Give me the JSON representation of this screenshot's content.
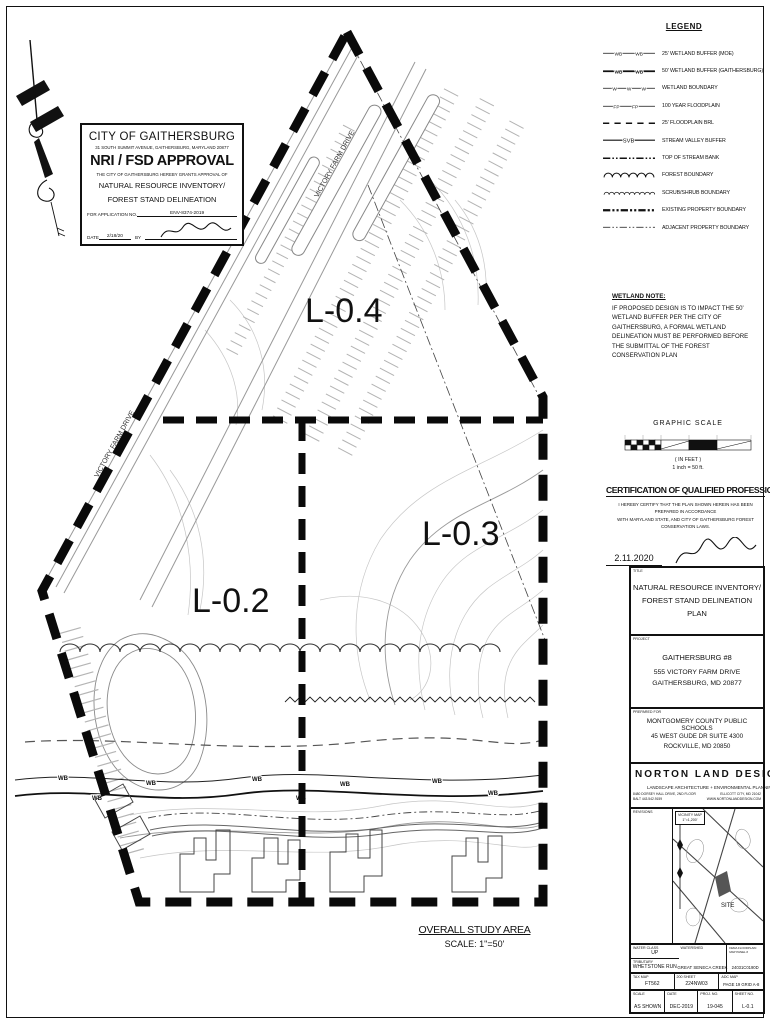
{
  "sheet": {
    "study_area_title": "OVERALL STUDY AREA",
    "study_area_scale": "SCALE: 1\"=50'"
  },
  "map": {
    "labels": {
      "l04": "L-0.4",
      "l03": "L-0.3",
      "l02": "L-0.2",
      "road": "VICTORY FARM DRIVE",
      "wb": "WB"
    }
  },
  "stamp": {
    "line1": "CITY OF GAITHERSBURG",
    "line2": "31 SOUTH SUMMIT AVENUE, GAITHERSBURG, MARYLAND 20877",
    "line3": "NRI / FSD APPROVAL",
    "line4": "THE CITY OF GAITHERSBURG HEREBY GRANTS APPROVAL OF",
    "line5": "NATURAL RESOURCE INVENTORY/",
    "line6": "FOREST STAND DELINEATION",
    "app_label": "FOR APPLICATION NO.",
    "app_no": "ENV-8374-2019",
    "date_label": "DATE",
    "date_value": "2/18/20",
    "by_label": "BY"
  },
  "legend": {
    "title": "LEGEND",
    "wb_marker": "WB",
    "w_marker": "W",
    "fp_marker": "FP",
    "svb_marker": "SVB",
    "items": [
      {
        "symbol": "wetland-buffer-25",
        "label": "25' WETLAND BUFFER (MOE)"
      },
      {
        "symbol": "wetland-buffer-50",
        "label": "50' WETLAND BUFFER (GAITHERSBURG)"
      },
      {
        "symbol": "wetland-boundary",
        "label": "WETLAND BOUNDARY"
      },
      {
        "symbol": "floodplain-100yr",
        "label": "100 YEAR FLOODPLAIN"
      },
      {
        "symbol": "floodplain-brl",
        "label": "25' FLOODPLAIN BRL"
      },
      {
        "symbol": "stream-valley-buffer",
        "label": "STREAM VALLEY BUFFER"
      },
      {
        "symbol": "top-of-stream-bank",
        "label": "TOP OF STREAM BANK"
      },
      {
        "symbol": "forest-boundary",
        "label": "FOREST BOUNDARY"
      },
      {
        "symbol": "scrub-shrub-boundary",
        "label": "SCRUB/SHRUB BOUNDARY"
      },
      {
        "symbol": "existing-property-boundary",
        "label": "EXISTING PROPERTY BOUNDARY"
      },
      {
        "symbol": "adjacent-property-boundary",
        "label": "ADJACENT PROPERTY BOUNDARY"
      }
    ]
  },
  "wetland_note": {
    "title": "WETLAND NOTE:",
    "body": "IF PROPOSED DESIGN IS TO IMPACT THE 50'\nWETLAND BUFFER PER THE CITY OF\nGAITHERSBURG, A FORMAL WETLAND\nDELINEATION MUST BE PERFORMED BEFORE\nTHE SUBMITTAL OF THE FOREST\nCONSERVATION PLAN"
  },
  "graphic_scale": {
    "title": "GRAPHIC SCALE",
    "in_feet": "( IN FEET )",
    "ratio": "1 inch = 50  ft."
  },
  "certification": {
    "title": "CERTIFICATION OF QUALIFIED PROFESSIONAL",
    "body": "I HEREBY CERTIFY THAT THE PLAN SHOWN HEREIN HAS BEEN PREPARED IN ACCORDANCE\nWITH MARYLAND STATE, AND CITY OF GAITHERSBURG FOREST CONSERVATION LAWS.",
    "date_value": "2.11.2020",
    "date_label": "DATE",
    "name": "MICHAEL N. NORTON",
    "credential": "MDNR / COMAR 08.19.06.01",
    "role": "QUALIFIED PROFESSIONAL"
  },
  "title_block": {
    "title": {
      "label": "TITLE",
      "text": "NATURAL RESOURCE INVENTORY/\nFOREST STAND DELINEATION PLAN"
    },
    "project": {
      "label": "PROJECT",
      "line1": "GAITHERSBURG #8",
      "line2": "555 VICTORY FARM DRIVE",
      "line3": "GAITHERSBURG, MD 20877"
    },
    "prepared": {
      "label": "PREPARED FOR",
      "line1": "MONTGOMERY COUNTY PUBLIC SCHOOLS",
      "line2": "45 WEST GUDE DR SUITE 4300",
      "line3": "ROCKVILLE, MD 20850"
    },
    "firm": {
      "name": "NORTON LAND DESIGN",
      "tagline": "LANDSCAPE ARCHITECTURE + ENVIRONMENTAL PLANNING",
      "address": "8480 DORSEY HALL DRIVE, 2ND FLOOR",
      "city": "ELLICOTT CITY, MD 21042",
      "phone": "BALT 443.542.9159",
      "web": "WWW.NORTONLANDDESIGN.COM"
    },
    "revisions_label": "REVISIONS",
    "vicinity": {
      "label": "VICINITY MAP",
      "scale": "1\"=1,200'",
      "site": "SITE"
    },
    "grid": {
      "water_class": {
        "label": "WATER CLASS",
        "value": "UP"
      },
      "tributary": {
        "label": "TRIBUTARY",
        "value": "WHETSTONE RUN"
      },
      "watershed": {
        "label": "WATERSHED",
        "value": "GREAT SENECA CREEK"
      },
      "fema": {
        "label": "FEMA FLOODPLAIN MAP PANEL #",
        "value": "24031C0190D"
      },
      "tax_map": {
        "label": "TAX MAP",
        "value": "FT562"
      },
      "sheet200": {
        "label": "200 SHEET",
        "value": "224NW03"
      },
      "adc": {
        "label": "ADC MAP",
        "value": "PAGE 19  GRID A-8"
      },
      "scale": {
        "label": "SCALE",
        "value": "AS SHOWN"
      },
      "date": {
        "label": "DATE",
        "value": "DEC-2019"
      },
      "proj": {
        "label": "PROJ. NO.",
        "value": "19-045"
      },
      "sheet": {
        "label": "SHEET NO.",
        "value": "L-0.1"
      }
    }
  }
}
